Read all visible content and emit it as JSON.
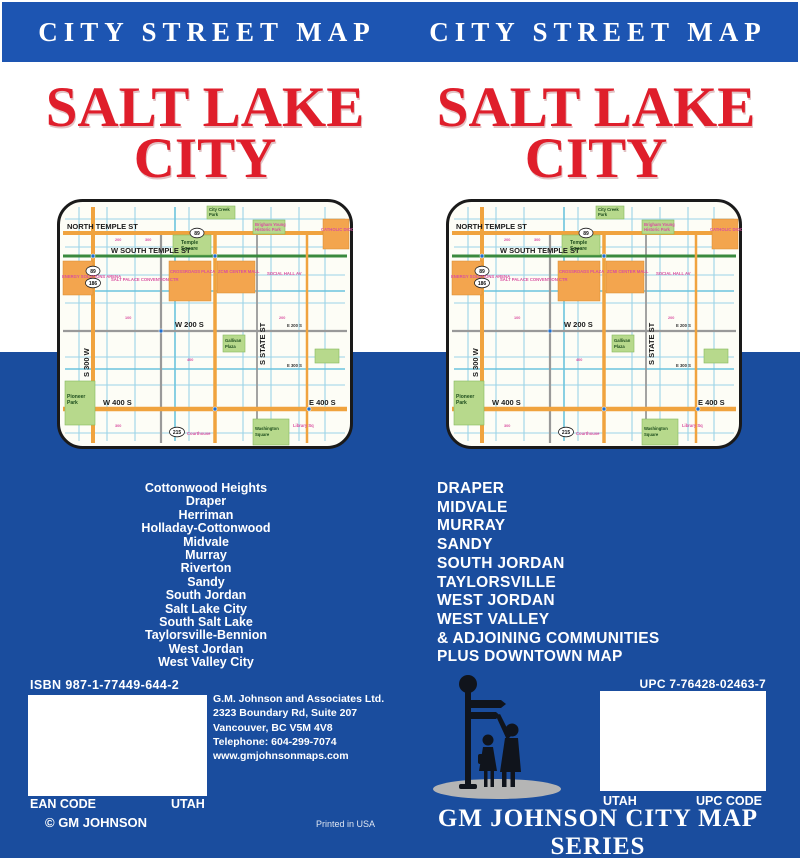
{
  "colors": {
    "band_blue": "#1d55b2",
    "body_blue": "#1a4d9e",
    "title_red": "#df1e2b",
    "road_orange": "#f0a33e",
    "park_green": "#b7d98c",
    "minor_street_blue": "#9bd4e8",
    "label_pink": "#d94fa0"
  },
  "band": {
    "title": "CITY STREET MAP"
  },
  "cover_title": {
    "line1": "SALT LAKE",
    "line2": "CITY"
  },
  "left_panel": {
    "cities": [
      "Cottonwood Heights",
      "Draper",
      "Herriman",
      "Holladay-Cottonwood",
      "Midvale",
      "Murray",
      "Riverton",
      "Sandy",
      "South Jordan",
      "Salt Lake City",
      "South Salt Lake",
      "Taylorsville-Bennion",
      "West Jordan",
      "West Valley City"
    ]
  },
  "right_panel": {
    "cities": [
      "DRAPER",
      "MIDVALE",
      "MURRAY",
      "SANDY",
      "SOUTH JORDAN",
      "TAYLORSVILLE",
      "WEST JORDAN",
      "WEST VALLEY"
    ],
    "extra": [
      "& ADJOINING COMMUNITIES",
      "PLUS DOWNTOWN MAP"
    ]
  },
  "map": {
    "route_shields": {
      "top": "89",
      "left_upper": "89",
      "left_lower": "186",
      "bottom": "215"
    },
    "street_labels": {
      "north_temple": "NORTH TEMPLE ST",
      "south_temple": "W SOUTH TEMPLE ST",
      "w200s": "W 200 S",
      "w400s": "W 400 S",
      "e400s": "E 400 S",
      "state_st": "S STATE ST",
      "s300w": "S 300 W",
      "e200s": "E 200 S",
      "e300s": "E 300 S"
    },
    "place_labels": {
      "temple_square_1": "Temple",
      "temple_square_2": "Square",
      "city_creek_1": "City Creek",
      "city_creek_2": "Park",
      "brigham_1": "Brigham Young",
      "brigham_2": "Historic Park",
      "pioneer_1": "Pioneer",
      "pioneer_2": "Park",
      "washington_1": "Washington",
      "washington_2": "Square",
      "gallivan_1": "Gallivan",
      "gallivan_2": "Plaza",
      "crossroads": "CROSSROADS PLAZA",
      "zcmi": "ZCMI CENTER MALL",
      "salt_palace": "SALT PALACE CONVENTION CTR",
      "arena": "ENERGY SOLUTIONS ARENA",
      "social_hall": "SOCIAL HALL AV",
      "catholic": "CATHOLIC DIOCESE",
      "courthouse": "Courthouse",
      "library": "Library Sq"
    },
    "block_numbers": [
      "200",
      "300",
      "100",
      "400",
      "200",
      "300"
    ]
  },
  "footer_left": {
    "isbn_line": "ISBN  987-1-77449-644-2",
    "ean_label": "EAN CODE",
    "state": "UTAH",
    "copyright": "© GM JOHNSON",
    "publisher": [
      "G.M. Johnson and Associates Ltd.",
      "2323 Boundary Rd, Suite 207",
      "Vancouver, BC  V5M 4V8",
      "Telephone:  604-299-7074",
      "www.gmjohnsonmaps.com"
    ],
    "printed": "Printed in USA"
  },
  "footer_right": {
    "upc_line": "UPC  7-76428-02463-7",
    "state": "UTAH",
    "upc_code_label": "UPC CODE",
    "series": "GM JOHNSON CITY MAP SERIES"
  }
}
